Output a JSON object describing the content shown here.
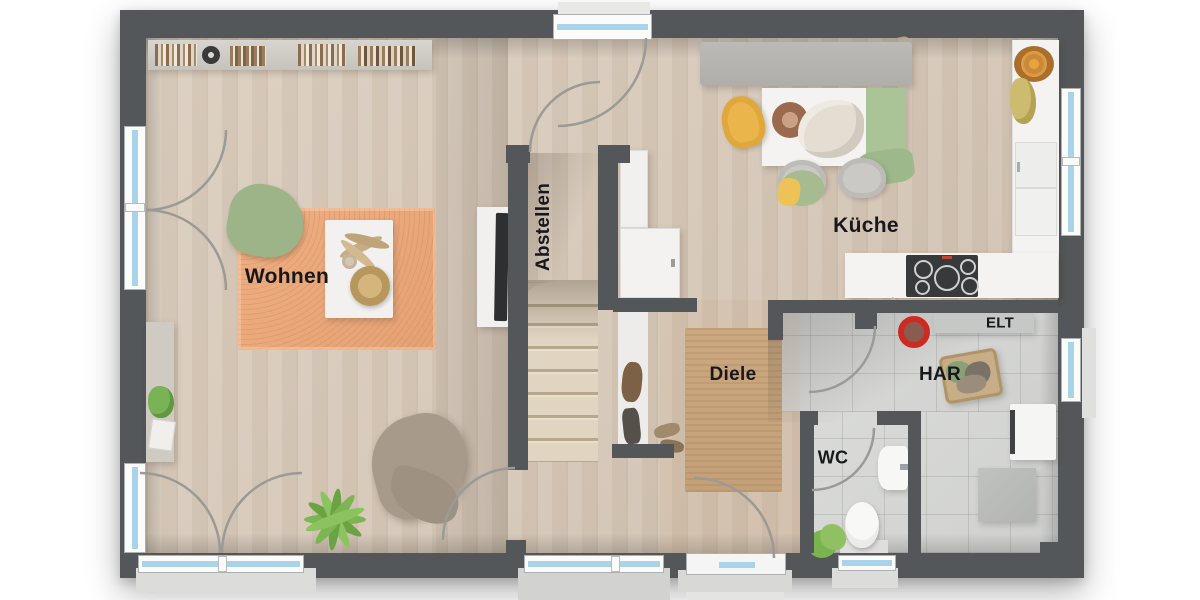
{
  "title": "Erdgeschoss Grundriss",
  "rooms": {
    "wohnen": {
      "label": "Wohnen"
    },
    "abstellen": {
      "label": "Abstellen"
    },
    "kueche": {
      "label": "Küche"
    },
    "diele": {
      "label": "Diele"
    },
    "wc": {
      "label": "WC"
    },
    "har": {
      "label": "HAR"
    },
    "elt": {
      "label": "ELT"
    }
  },
  "colors": {
    "wall": "#54575a",
    "floor_wood": "#d6c8b8",
    "floor_tile": "#d5d6d4",
    "rug_living": "#eba97d",
    "rug_hall": "#c9a87f",
    "window_glass": "#a9d3e8",
    "accent_orange": "#ec8a30",
    "accent_yellow": "#edc257",
    "accent_green": "#a6bc90",
    "furniture_white": "#f4f3f1",
    "sofa_grey": "#b4b2ae"
  }
}
